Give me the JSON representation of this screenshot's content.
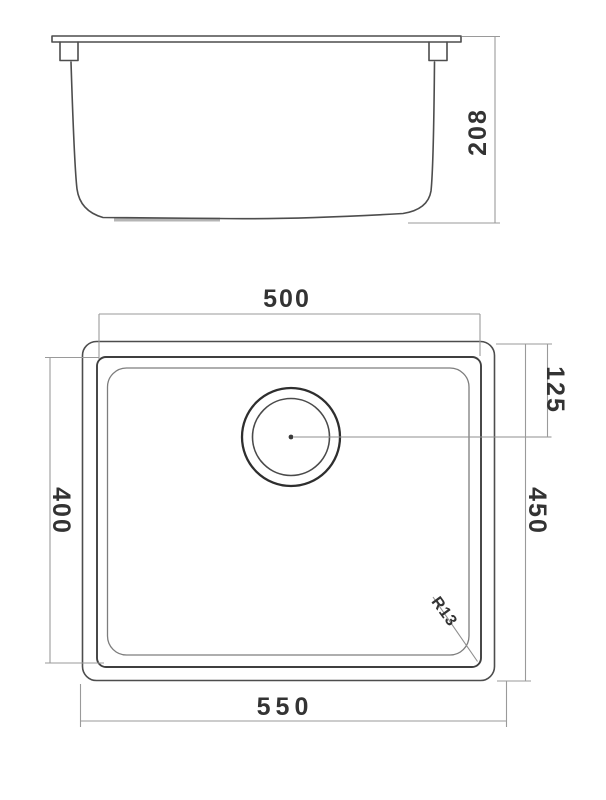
{
  "document": {
    "type": "technical-drawing",
    "subject": "undermount-sink",
    "colors": {
      "background": "#ffffff",
      "outline": "#4d4d4d",
      "dimension_lines": "#9a9a9a",
      "dimension_text": "#333333"
    }
  },
  "side_view": {
    "dimensions": {
      "height": {
        "label": "208"
      }
    }
  },
  "plan_view": {
    "dimensions": {
      "bowl_width": {
        "label": "500"
      },
      "drain_offset": {
        "label": "125"
      },
      "bowl_depth": {
        "label": "400"
      },
      "overall_depth": {
        "label": "450"
      },
      "overall_width": {
        "label": "550"
      },
      "corner_radius": {
        "label": "R13"
      }
    }
  }
}
